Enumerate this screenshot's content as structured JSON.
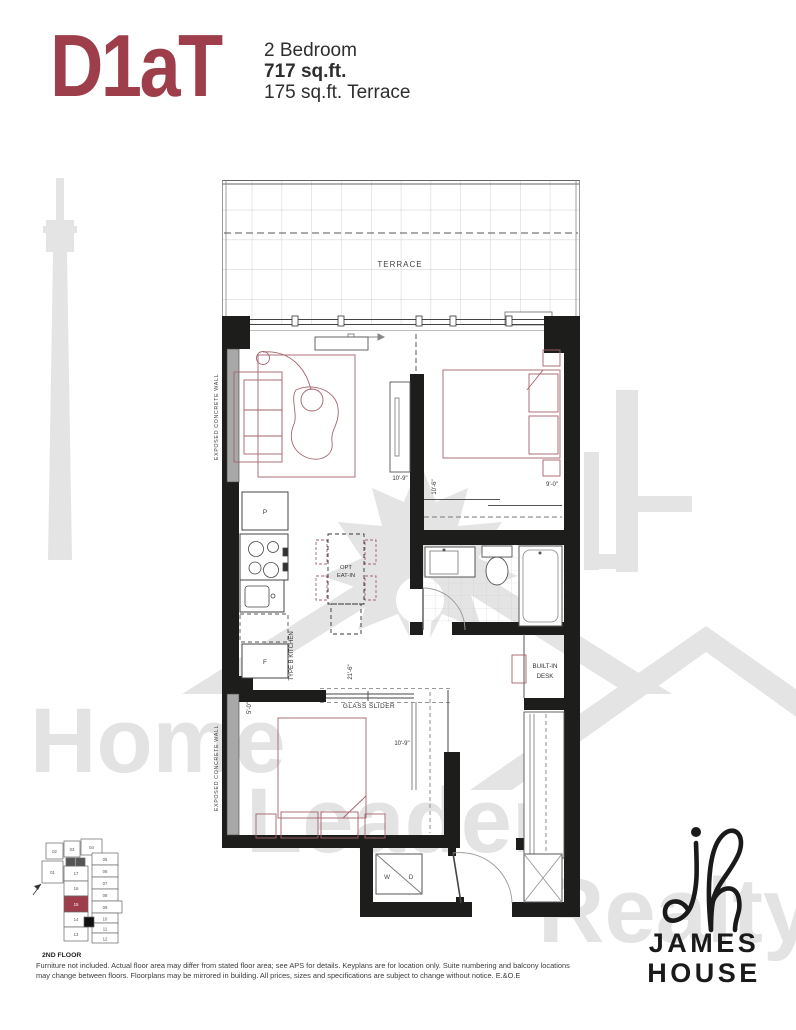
{
  "header": {
    "plan_name": "D1aT",
    "unit_type": "2 Bedroom",
    "area": "717 sq.ft.",
    "terrace": "175 sq.ft. Terrace"
  },
  "plan": {
    "labels": {
      "terrace": "TERRACE",
      "glass_slider": "GLASS SLIDER",
      "opt_1": "OPT",
      "opt_2": "EAT-IN",
      "kitchen": "TYPE B KITCHEN",
      "desk_1": "BUILT-IN",
      "desk_2": "DESK",
      "concrete": "EXPOSED CONCRETE WALL",
      "pantry": "P",
      "fridge": "F",
      "washer": "W",
      "dryer": "D"
    },
    "dims": {
      "living": "10'-9\"",
      "bed1_w": "10'-6\"",
      "bed1_l": "9'-0\"",
      "kitchen_run": "21'-6\"",
      "slider": "5'-0\"",
      "bed2": "10'-9\""
    }
  },
  "keyplan": {
    "floor": "2ND FLOOR",
    "highlighted_unit": "15",
    "units": [
      "01",
      "02",
      "03",
      "04",
      "05",
      "06",
      "07",
      "08",
      "09",
      "10",
      "11",
      "12",
      "13",
      "14",
      "15",
      "16",
      "17"
    ]
  },
  "watermark": {
    "words": [
      "Home",
      "Leader",
      "Realty"
    ]
  },
  "logo": {
    "name_1": "JAMES",
    "name_2": "HOUSE"
  },
  "footer": {
    "line1": "Furniture not included. Actual floor area may differ from stated floor area; see APS for details. Keyplans are for location only. Suite numbering and balcony locations",
    "line2": "may change between floors. Floorplans may be mirrored in building. All prices, sizes and specifications are subject to change without notice. E.&O.E"
  },
  "colors": {
    "accent": "#9E3E4A",
    "furniture_line": "#A5636B",
    "wall": "#1D1D1B",
    "watermark": "#E4E4E4"
  }
}
